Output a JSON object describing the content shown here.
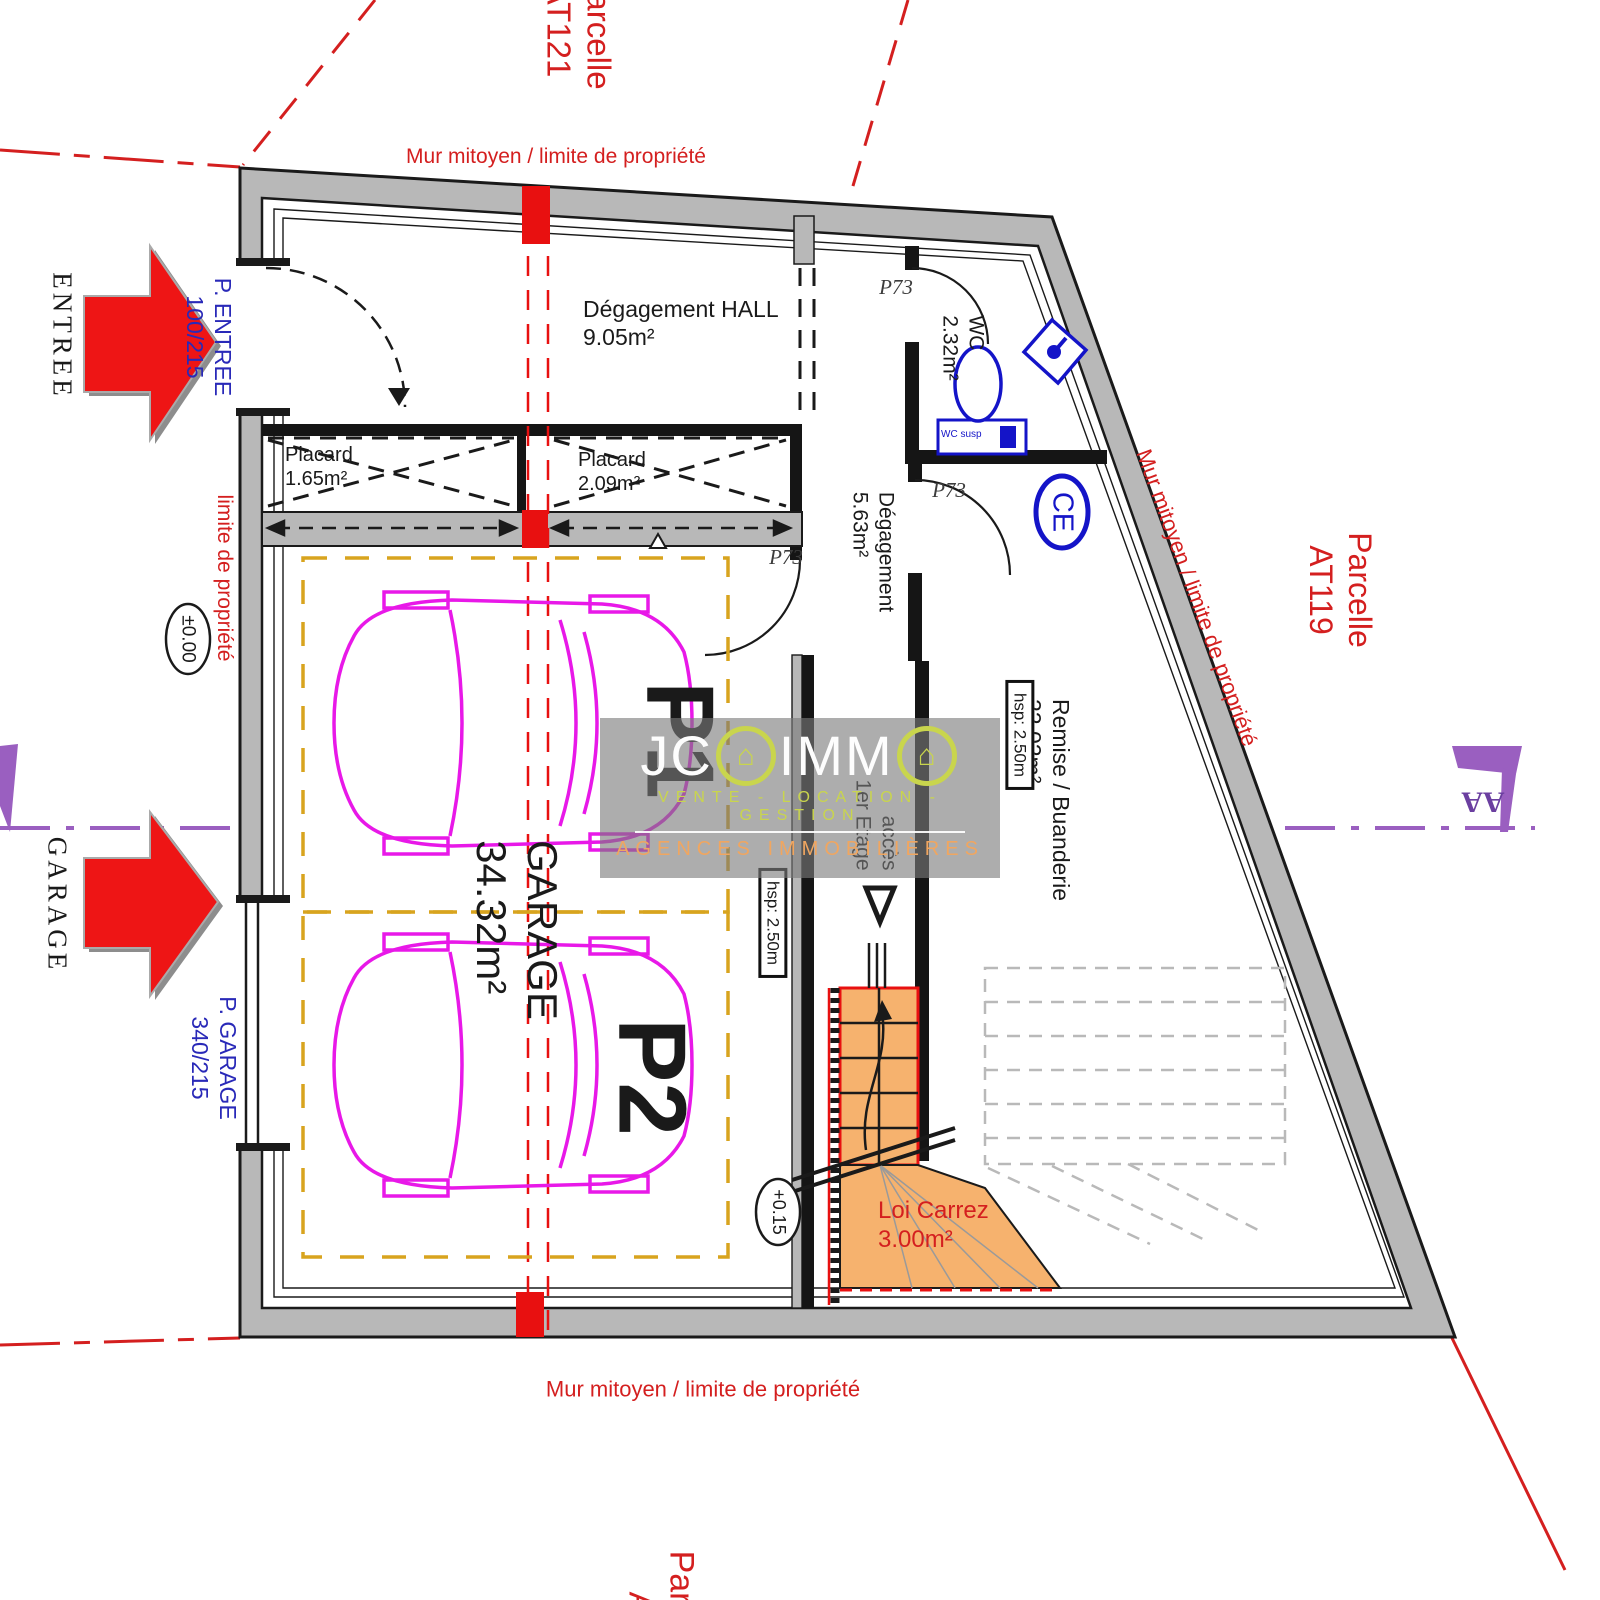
{
  "boundaries": {
    "mur_top": "Mur mitoyen / limite de propriété",
    "mur_bottom": "Mur mitoyen / limite de propriété",
    "mur_right": "Mur mitoyen / limite de propriété",
    "limite_left": "limite de propriété",
    "parcelle_top": {
      "line1": "Parcelle",
      "line2": "AT121"
    },
    "parcelle_right": {
      "line1": "Parcelle",
      "line2": "AT119"
    },
    "parcelle_bottom": {
      "line1": "Parcelle",
      "line2": "AT"
    }
  },
  "entrances": {
    "entree_label": "ENTREE",
    "garage_label": "GARAGE",
    "door_entree": {
      "line1": "P. ENTREE",
      "line2": "100/215"
    },
    "door_garage": {
      "line1": "P. GARAGE",
      "line2": "340/215"
    }
  },
  "levels": {
    "entry": "±0.00",
    "garage": "+0.15"
  },
  "rooms": {
    "hall": {
      "name": "Dégagement HALL",
      "area": "9.05m²"
    },
    "placard1": {
      "name": "Placard",
      "area": "1.65m²"
    },
    "placard2": {
      "name": "Placard",
      "area": "2.09m²"
    },
    "wc": {
      "name": "WC",
      "area": "2.32m²"
    },
    "degagement": {
      "name": "Dégagement",
      "area": "5.63m²"
    },
    "remise": {
      "name": "Remise / Buanderie",
      "area": "22.02m²"
    },
    "garage": {
      "name": "GARAGE",
      "area": "34.32m²"
    },
    "loi_carrez": {
      "name": "Loi Carrez",
      "area": "3.00m²"
    }
  },
  "annotations": {
    "hsp": "hsp: 2.50m",
    "p1": "P1",
    "p2": "P2",
    "door_ref": "P73",
    "ce": "CE",
    "acces": {
      "line1": "accès",
      "line2": "1er Etage"
    },
    "wc_susp": "WC susp",
    "section_marker": "AA"
  },
  "watermark": {
    "jc": "JC",
    "imm": "IMM",
    "house_icon": "⌂",
    "tagline": "VENTE - LOCATION - GESTION",
    "subtitle": "AGENCES IMMOBILIÈRES"
  },
  "colors": {
    "boundary_red": "#d41f1f",
    "label_blue": "#2929b8",
    "car_magenta": "#e818e8",
    "stall_yellow": "#d8a41e",
    "stair_orange": "#f6b26e",
    "section_purple": "#9a5fc0",
    "wall_gray": "#b8b8b8",
    "fixture_blue": "#1414c8",
    "watermark_green": "#c9d54d",
    "watermark_orange": "#f0a660"
  }
}
